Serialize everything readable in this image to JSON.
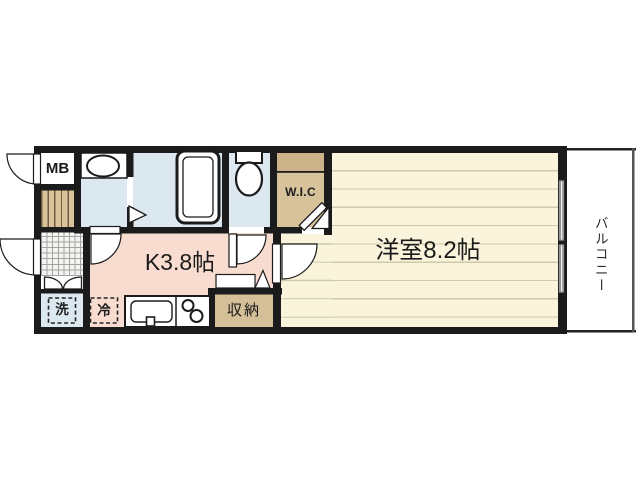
{
  "plan": {
    "meter_box": {
      "label": "MB"
    },
    "wic": {
      "label": "W.I.C"
    },
    "kitchen": {
      "label": "K3.8帖",
      "size_jo": 3.8
    },
    "western_room": {
      "label": "洋室8.2帖",
      "size_jo": 8.2
    },
    "storage": {
      "label": "収納"
    },
    "washer": {
      "label": "洗"
    },
    "fridge": {
      "label": "冷"
    },
    "balcony": {
      "label": "バルコニー"
    },
    "colors": {
      "wall": "#1b1b1b",
      "wet_area_floor": "#dce8f0",
      "kitchen_floor": "#f8dcd0",
      "wood_floor": "#f9f4db",
      "closet_tan": "#d6c39c",
      "balcony_edge": "#555555"
    }
  }
}
